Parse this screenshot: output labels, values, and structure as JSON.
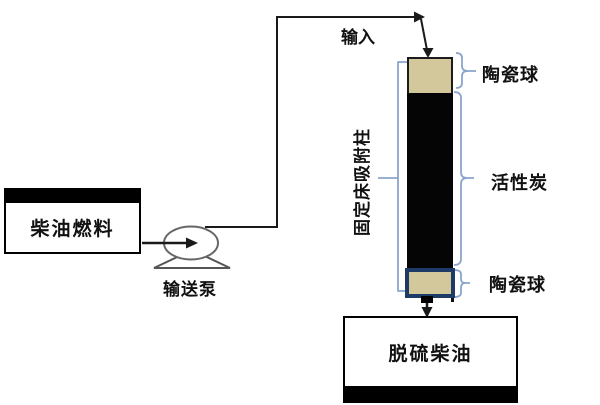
{
  "diagram": {
    "description": "fixed-bed-adsorption-desulfurization-flow",
    "labels": {
      "input": "输入",
      "diesel_fuel": "柴油燃料",
      "pump": "输送泵",
      "column": "固定床吸附柱",
      "ceramic_top": "陶瓷球",
      "activated_carbon": "活性炭",
      "ceramic_bottom": "陶瓷球",
      "desulfurized_diesel": "脱硫柴油"
    },
    "colors": {
      "ceramic_fill": "#d2c89c",
      "carbon_fill": "#050505",
      "column_bottom_border": "#1d3b66",
      "bracket_blue": "#8aa5cc",
      "line_color": "#1a1a1a",
      "pump_stroke": "#666666",
      "tank_border": "#000000",
      "background": "#ffffff"
    }
  }
}
